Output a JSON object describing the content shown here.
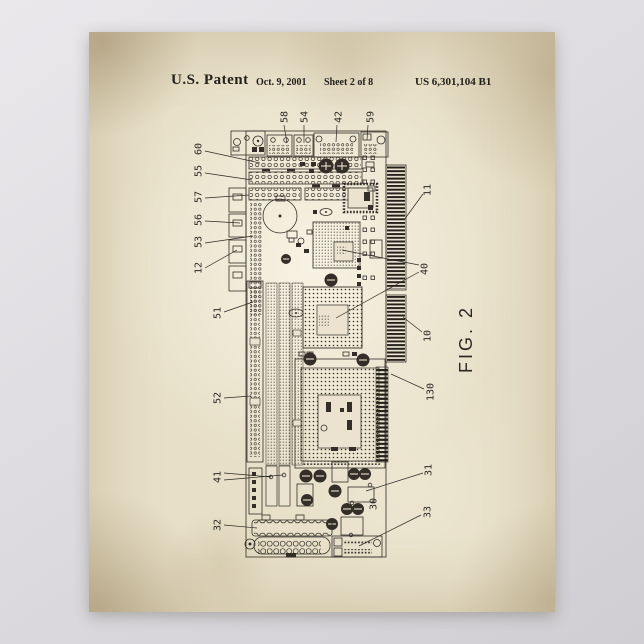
{
  "header": {
    "patent_label": "U.S. Patent",
    "date": "Oct. 9, 2001",
    "sheet": "Sheet 2 of 8",
    "patent_number": "US 6,301,104 B1"
  },
  "figure": {
    "caption": "FIG. 2",
    "subject": "single-board-computer circuit board drawing",
    "ink_color": "#332f28",
    "paper_color": "#e7dfc7",
    "labels": [
      {
        "t": "58",
        "x": 284,
        "y": 117,
        "L": [
          [
            284,
            125,
            287,
            143
          ]
        ]
      },
      {
        "t": "54",
        "x": 304,
        "y": 117,
        "L": [
          [
            304,
            125,
            304,
            143
          ]
        ]
      },
      {
        "t": "42",
        "x": 338,
        "y": 117,
        "L": [
          [
            337,
            125,
            336,
            142
          ]
        ]
      },
      {
        "t": "59",
        "x": 370,
        "y": 117,
        "L": [
          [
            368,
            125,
            367,
            140
          ]
        ]
      },
      {
        "t": "60",
        "x": 198,
        "y": 149,
        "L": [
          [
            205,
            151,
            260,
            163
          ]
        ]
      },
      {
        "t": "55",
        "x": 198,
        "y": 171,
        "L": [
          [
            205,
            173,
            252,
            180
          ]
        ]
      },
      {
        "t": "57",
        "x": 198,
        "y": 197,
        "L": [
          [
            205,
            198,
            249,
            195
          ]
        ]
      },
      {
        "t": "56",
        "x": 198,
        "y": 220,
        "L": [
          [
            205,
            221,
            240,
            223
          ]
        ]
      },
      {
        "t": "53",
        "x": 198,
        "y": 242,
        "L": [
          [
            205,
            243,
            253,
            236
          ]
        ]
      },
      {
        "t": "12",
        "x": 198,
        "y": 268,
        "L": [
          [
            205,
            268,
            237,
            250
          ]
        ]
      },
      {
        "t": "51",
        "x": 217,
        "y": 313,
        "L": [
          [
            224,
            312,
            253,
            302
          ]
        ]
      },
      {
        "t": "52",
        "x": 217,
        "y": 398,
        "L": [
          [
            224,
            398,
            251,
            396
          ]
        ]
      },
      {
        "t": "41",
        "x": 217,
        "y": 477,
        "L": [
          [
            224,
            473,
            271,
            477
          ],
          [
            224,
            480,
            283,
            475
          ]
        ]
      },
      {
        "t": "32",
        "x": 217,
        "y": 525,
        "L": [
          [
            224,
            525,
            257,
            528
          ]
        ]
      },
      {
        "t": "11",
        "x": 427,
        "y": 190,
        "L": [
          [
            423,
            194,
            404,
            220
          ]
        ]
      },
      {
        "t": "40",
        "x": 424,
        "y": 269,
        "L": [
          [
            419,
            265,
            342,
            250
          ],
          [
            419,
            272,
            336,
            318
          ]
        ]
      },
      {
        "t": "10",
        "x": 427,
        "y": 336,
        "L": [
          [
            422,
            332,
            403,
            317
          ]
        ]
      },
      {
        "t": "130",
        "x": 430,
        "y": 392,
        "L": [
          [
            424,
            389,
            391,
            374
          ]
        ]
      },
      {
        "t": "31",
        "x": 428,
        "y": 470,
        "L": [
          [
            423,
            473,
            366,
            491
          ]
        ]
      },
      {
        "t": "33",
        "x": 427,
        "y": 512,
        "L": [
          [
            421,
            515,
            359,
            546
          ]
        ]
      },
      {
        "t": "30",
        "x": 373,
        "y": 504,
        "L": []
      }
    ]
  }
}
